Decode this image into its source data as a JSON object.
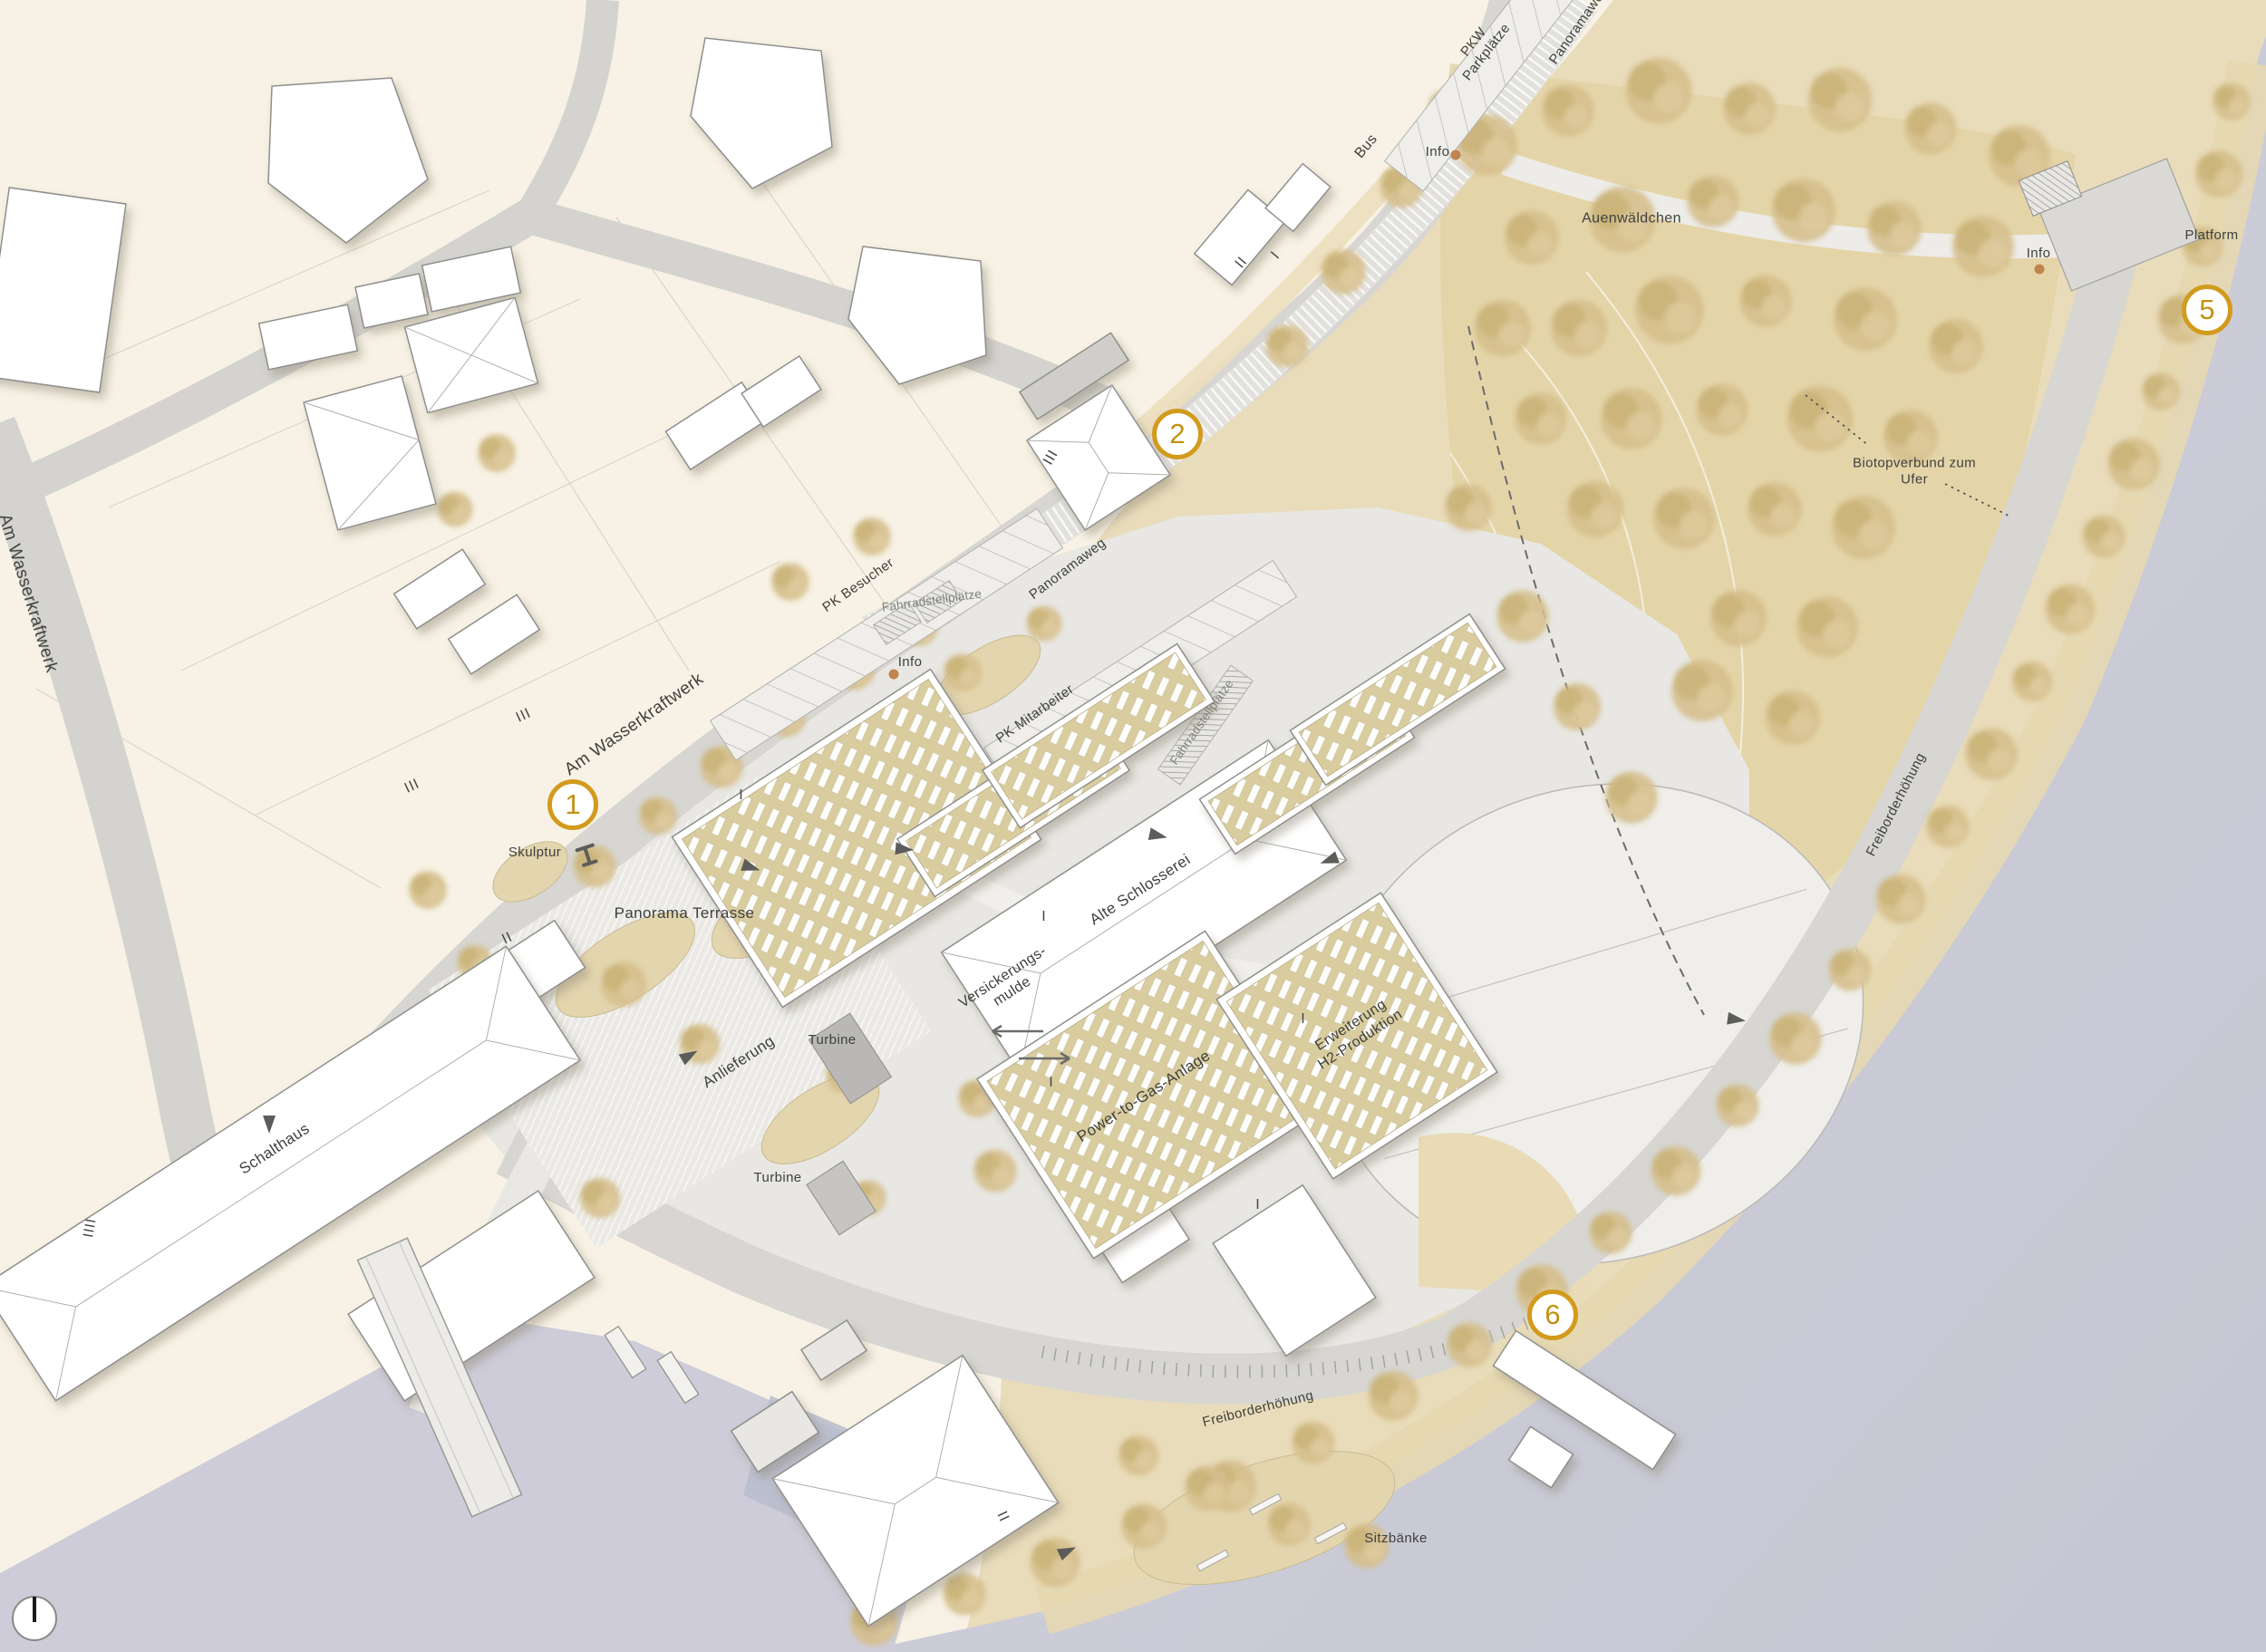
{
  "colors": {
    "paper": "#f7f2e5",
    "meadow": "#e9dcba",
    "tree": "#d2bc86",
    "water": "#c9c9d6",
    "road": "#d7d6d2",
    "hardscape": "#e8e7e3",
    "building_outline": "#8f8f8d",
    "green_roof": "#d9cda0",
    "marker_gold": "#d29b1e",
    "info_dot": "#c0854f",
    "label_text": "#3f3f3c"
  },
  "icons": {
    "north": "north-indicator-icon",
    "info": "info-dot-icon",
    "sculpture": "sculpture-icon",
    "direction": "direction-arrow-icon"
  },
  "markers": [
    {
      "number": "1"
    },
    {
      "number": "2"
    },
    {
      "number": "5"
    },
    {
      "number": "6"
    }
  ],
  "labels": {
    "am_wasserkraftwerk_edge": {
      "text": "Am Wasserkraftwerk"
    },
    "pkw_parkplaetze": {
      "text": "PKW\nParkplätze"
    },
    "panoramaweg_top": {
      "text": "Panoramaweg"
    },
    "bus": {
      "text": "Bus"
    },
    "info_top": {
      "text": "Info"
    },
    "auenwaeldchen": {
      "text": "Auenwäldchen"
    },
    "info_right": {
      "text": "Info"
    },
    "platform": {
      "text": "Platform"
    },
    "biotopverbund": {
      "text": "Biotopverbund zum\nUfer"
    },
    "panoramaweg_mid": {
      "text": "Panoramaweg"
    },
    "pk_besucher": {
      "text": "PK Besucher"
    },
    "fahrradstellplaetze_nord": {
      "text": "Fahrradstellplätze"
    },
    "info_mitte": {
      "text": "Info"
    },
    "am_wasserkraftwerk": {
      "text": "Am Wasserkraftwerk"
    },
    "pk_mitarbeiter": {
      "text": "PK Mitarbeiter"
    },
    "fahrradstellplaetze_ost": {
      "text": "Fahrradstellplätze"
    },
    "skulptur": {
      "text": "Skulptur"
    },
    "panorama_terrasse": {
      "text": "Panorama Terrasse"
    },
    "alte_schlosserei": {
      "text": "Alte Schlosserei"
    },
    "versickerungsmulde": {
      "text": "Versickerungs-\nmulde"
    },
    "erweiterung_h2": {
      "text": "Erweiterung\nH2-Produktion"
    },
    "anlieferung": {
      "text": "Anlieferung"
    },
    "turbine_nord": {
      "text": "Turbine"
    },
    "power_to_gas": {
      "text": "Power-to-Gas-Anlage"
    },
    "schalthaus": {
      "text": "Schalthaus"
    },
    "turbine_sued": {
      "text": "Turbine"
    },
    "freiborderhoehung_ufer": {
      "text": "Freiborderhöhung"
    },
    "freiborderhoehung_sued": {
      "text": "Freiborderhöhung"
    },
    "sitzbaenke": {
      "text": "Sitzbänke"
    }
  },
  "storey_marks": [
    {
      "text": "III"
    },
    {
      "text": "III"
    },
    {
      "text": "III"
    },
    {
      "text": "IIII"
    },
    {
      "text": "II"
    },
    {
      "text": "I"
    },
    {
      "text": "I"
    },
    {
      "text": "I"
    },
    {
      "text": "I"
    },
    {
      "text": "I"
    },
    {
      "text": "II"
    },
    {
      "text": "II"
    },
    {
      "text": "I"
    }
  ]
}
